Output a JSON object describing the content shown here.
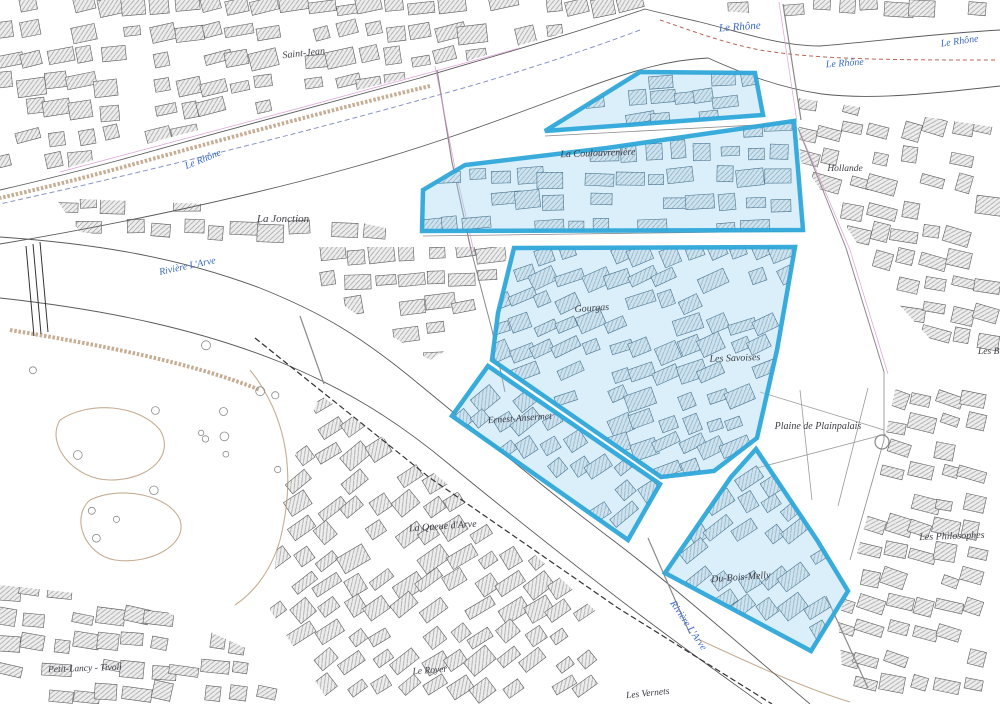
{
  "map": {
    "width": 1000,
    "height": 704,
    "colors": {
      "zone_stroke": "#2ba6d9",
      "zone_fill": "rgba(158,212,238,0.38)",
      "water_label": "#3a6cc8",
      "district_label": "#3c3c44",
      "bank": "#5a5a5a",
      "tan": "#b3926f",
      "pink": "#d88fd0",
      "rail": "#333333",
      "road": "#8a8a8a",
      "boundary_red": "#bb6655",
      "boundary_blue": "#8894c8",
      "tree": "#8a8a8a",
      "hatch_bg": "#ededed",
      "hatch_line": "#a9a9a9",
      "hatch_blue_bg": "#cfe3ee",
      "hatch_blue_line": "#8fb5cc",
      "block_stroke_gray": "#5c5c5c",
      "block_stroke_blue": "#4a7490",
      "plaine_path": "#999999"
    },
    "zones": [
      {
        "name": "coulouvreniere-nord",
        "points": "640,72 755,73 763,115 545,131",
        "rot": -5,
        "step": 22
      },
      {
        "name": "la-coulouvreniere",
        "points": "794,121 607,148 465,165 423,190 422,231 803,230",
        "rot": -2,
        "step": 25
      },
      {
        "name": "gourgas-les-savoises",
        "points": "514,248 795,247 777,350 757,438 714,471 661,477 492,360 498,313",
        "rot": -22,
        "step": 24
      },
      {
        "name": "ernest-ansermet",
        "points": "488,366 660,484 628,540 452,416",
        "rot": -35,
        "step": 24
      },
      {
        "name": "du-bois-melly",
        "points": "756,449 817,540 848,591 811,651 665,573 731,477",
        "rot": -35,
        "step": 25
      }
    ],
    "districts": [
      {
        "name": "saint-jean",
        "points": "0,0 650,0 642,12 520,45 420,75 290,106 160,140 60,170 0,186",
        "rot": -10
      },
      {
        "name": "quai-nord-est",
        "points": "710,0 1000,0 1000,28 850,22 712,10",
        "rot": 0
      },
      {
        "name": "hollande",
        "points": "798,98 1000,128 1000,360 940,350 895,300 845,225 800,160",
        "rot": 12
      },
      {
        "name": "plainpalais-est",
        "points": "895,390 1000,365 1000,704 845,704 838,620 872,500",
        "rot": 15
      },
      {
        "name": "jonction-pointe",
        "points": "55,198 230,205 340,218 425,237 340,252 200,245 80,232",
        "rot": 2
      },
      {
        "name": "jonction-est",
        "points": "300,247 508,247 496,320 430,360 350,310 300,270",
        "rot": -6
      },
      {
        "name": "acacias-queue-arve",
        "points": "320,395 430,470 530,550 600,615 615,704 330,704 270,610 285,480",
        "rot": -35
      },
      {
        "name": "petit-lancy",
        "points": "0,585 140,600 250,650 295,704 0,704",
        "rot": 8
      }
    ],
    "rivers": [
      {
        "name": "rhone-north-bank",
        "d": "M1000,30 C930,34 870,42 820,46 C780,46 740,32 700,22 C670,15 652,11 645,9 C560,38 480,60 420,78 C330,102 220,132 120,160 C75,172 35,182 0,190"
      },
      {
        "name": "rhone-south-bank",
        "d": "M1000,86 C930,94 870,100 822,94 C780,88 744,74 708,58 C670,60 640,68 580,90 C500,120 430,146 350,168 C250,196 120,224 0,244"
      },
      {
        "name": "arve-north-bank",
        "d": "M0,237 C100,244 180,258 260,288 C320,312 360,335 420,385 C480,434 540,485 610,538 C670,583 740,645 810,704"
      },
      {
        "name": "arve-south-bank",
        "d": "M0,298 C110,310 200,330 280,362 C340,387 390,415 450,465 C510,514 570,562 640,615 C700,660 740,688 762,704"
      }
    ],
    "boundaries": [
      {
        "name": "canton-boundary-rhone",
        "d": "M640,30 C560,60 480,84 420,100 C320,128 200,158 80,186 L0,204",
        "color": "#8894c8",
        "dash": "5,3",
        "w": 1
      },
      {
        "name": "boundary-upper-rhone",
        "d": "M995,60 C900,60 820,60 760,50 C720,42 690,30 660,20",
        "color": "#bb6655",
        "dash": "4,3",
        "w": 1
      }
    ],
    "contours": [
      "M430,86 C330,110 220,140 120,168 C75,180 35,190 0,198",
      "M10,330 C100,345 190,362 260,390",
      "M60,420 C90,400 140,405 160,430 C175,455 150,480 110,480 C75,480 45,445 60,420",
      "M90,500 C120,485 170,495 180,520 C188,545 150,565 115,560 C85,555 70,518 90,500",
      "M250,370 C290,420 295,480 280,540 C270,575 250,595 235,605",
      "M700,640 C760,668 810,690 850,702"
    ],
    "roads": [
      {
        "d": "M437,70 L452,162 L471,250",
        "w": 1.2
      },
      {
        "d": "M471,250 L492,330 L505,392",
        "w": 1
      },
      {
        "d": "M783,4 L801,120",
        "w": 1.2
      },
      {
        "d": "M300,316 L324,384",
        "w": 1.2
      },
      {
        "d": "M648,538 L690,634",
        "w": 1.2
      },
      {
        "d": "M826,596 L868,688",
        "w": 1.2
      },
      {
        "d": "M798,128 L846,248 L884,372",
        "w": 1
      },
      {
        "d": "M884,372 L884,440 L850,560",
        "w": 0.8
      },
      {
        "d": "M545,136 L795,123",
        "w": 0.8
      },
      {
        "d": "M423,236 L804,231",
        "w": 0.8
      }
    ],
    "pink_lines": [
      "M435,66 L455,168 L474,252",
      "M779,2 L797,122",
      "M60,172 L300,108 L520,48",
      "M800,132 L850,250 L888,374"
    ],
    "railways": [
      {
        "d": "M255,338 L430,478 L618,608 L772,704",
        "w": 1.2,
        "dash": "6,3"
      },
      {
        "d": "M26,246 L34,336",
        "w": 1,
        "dash": ""
      },
      {
        "d": "M33,244 L41,334",
        "w": 1,
        "dash": ""
      },
      {
        "d": "M40,242 L48,332",
        "w": 1,
        "dash": ""
      }
    ],
    "plaine": {
      "paths": [
        "M760,392 L884,430",
        "M868,388 L838,506",
        "M757,468 L886,434",
        "M800,390 L812,500"
      ],
      "roundabout": {
        "cx": 882,
        "cy": 442,
        "r": 7
      }
    },
    "park": {
      "x0": 30,
      "y0": 345,
      "x1": 285,
      "y1": 585,
      "tree_count": 16
    },
    "labels": [
      {
        "text": "Le Rhône",
        "x": 740,
        "y": 30,
        "rot": -4,
        "kind": "water",
        "size": 11
      },
      {
        "text": "Le Rhône",
        "x": 845,
        "y": 66,
        "rot": -4,
        "kind": "water",
        "size": 10
      },
      {
        "text": "Le Rhône",
        "x": 960,
        "y": 44,
        "rot": -8,
        "kind": "water",
        "size": 10
      },
      {
        "text": "Le Rhône",
        "x": 204,
        "y": 162,
        "rot": -22,
        "kind": "water",
        "size": 10
      },
      {
        "text": "Rivière L'Arve",
        "x": 188,
        "y": 269,
        "rot": -12,
        "kind": "water",
        "size": 10
      },
      {
        "text": "Rivière L'Arve",
        "x": 686,
        "y": 627,
        "rot": 56,
        "kind": "water",
        "size": 10
      },
      {
        "text": "Saint-Jean",
        "x": 304,
        "y": 56,
        "rot": -6,
        "kind": "district",
        "size": 10
      },
      {
        "text": "La Jonction",
        "x": 283,
        "y": 222,
        "rot": 0,
        "kind": "district",
        "size": 11
      },
      {
        "text": "La Coulouvrenière",
        "x": 598,
        "y": 156,
        "rot": -2,
        "kind": "district",
        "size": 10
      },
      {
        "text": "Gourgas",
        "x": 592,
        "y": 311,
        "rot": -4,
        "kind": "district",
        "size": 10
      },
      {
        "text": "Les Savoises",
        "x": 735,
        "y": 361,
        "rot": -2,
        "kind": "district",
        "size": 10
      },
      {
        "text": "Ernest-Ansermet",
        "x": 520,
        "y": 421,
        "rot": -4,
        "kind": "district",
        "size": 9.5
      },
      {
        "text": "Hollande",
        "x": 845,
        "y": 171,
        "rot": 0,
        "kind": "district",
        "size": 9.5
      },
      {
        "text": "Les B",
        "x": 978,
        "y": 354,
        "rot": 0,
        "kind": "district",
        "size": 9.5,
        "anchor": "start"
      },
      {
        "text": "Les Philosophes",
        "x": 952,
        "y": 539,
        "rot": -2,
        "kind": "district",
        "size": 10
      },
      {
        "text": "Plaine de Plainpalais",
        "x": 818,
        "y": 429,
        "rot": 0,
        "kind": "district",
        "size": 10
      },
      {
        "text": "La Queue d'Arve",
        "x": 443,
        "y": 529,
        "rot": -4,
        "kind": "district",
        "size": 10
      },
      {
        "text": "Du-Bois-Melly",
        "x": 741,
        "y": 580,
        "rot": -4,
        "kind": "district",
        "size": 10
      },
      {
        "text": "Petit-Lancy - Tivoli",
        "x": 85,
        "y": 671,
        "rot": -2,
        "kind": "district",
        "size": 9.5
      },
      {
        "text": "Le Royer",
        "x": 430,
        "y": 673,
        "rot": -4,
        "kind": "district",
        "size": 9.5
      },
      {
        "text": "Les Vernets",
        "x": 648,
        "y": 696,
        "rot": -6,
        "kind": "district",
        "size": 9.5
      }
    ]
  }
}
